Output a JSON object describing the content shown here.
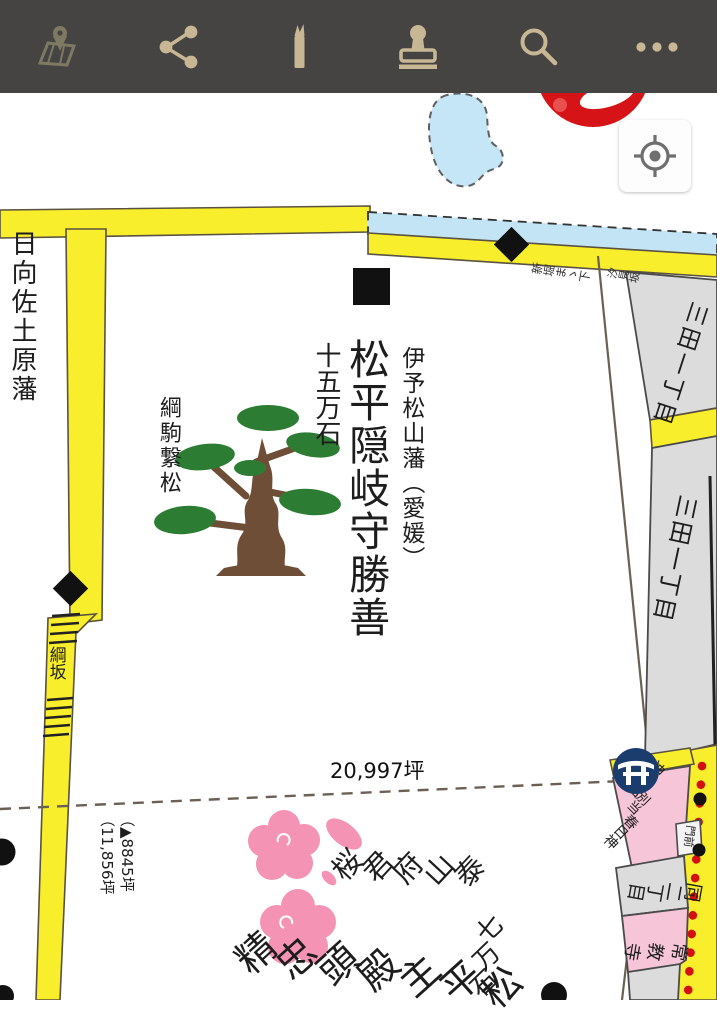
{
  "toolbar": {
    "background": "#454442",
    "icon_color": "#c7b794",
    "icons": [
      {
        "name": "map"
      },
      {
        "name": "share"
      },
      {
        "name": "pen"
      },
      {
        "name": "stamp"
      },
      {
        "name": "search"
      },
      {
        "name": "more"
      }
    ]
  },
  "map": {
    "colors": {
      "road_yellow": "#f8ee2b",
      "canal_blue": "#c2e4f5",
      "parcel_gray": "#dcdcdc",
      "parcel_pink": "#f6c6d8",
      "dot_red": "#d40f0f",
      "logo_red": "#d61418",
      "torii_navy": "#1b3d6e",
      "pine_green": "#2d7c33",
      "pine_trunk": "#6f4e38",
      "blossom_pink": "#f493b4"
    },
    "labels": {
      "west_estate": "日向佐土原藩",
      "estate_domain": "伊予松山藩（愛媛）",
      "estate_lord": "松平隠岐守勝善",
      "estate_stipend": "十五万石",
      "pine_tree": "綱駒繋松",
      "slope_west": "綱坂",
      "slope_east": "汐見坂",
      "canal_note": "新堀まゝ下",
      "area_main": "20,997坪",
      "area_alt_line1": "（▲8845坪",
      "area_alt_line2": "（11,856坪",
      "town_block_upper": "三田一丁目",
      "town_block_lower": "三田一丁目",
      "town_block_south": "同二丁目",
      "monzen": "門前",
      "temple": "常教寺",
      "shrine_line1": "神明宮",
      "shrine_line2": "別当",
      "shrine_line3": "春日神",
      "sakura": "泰山府君桜",
      "south_estate_lord": "松平主殿頭忠精",
      "south_estate_stipend": "七万石"
    }
  }
}
